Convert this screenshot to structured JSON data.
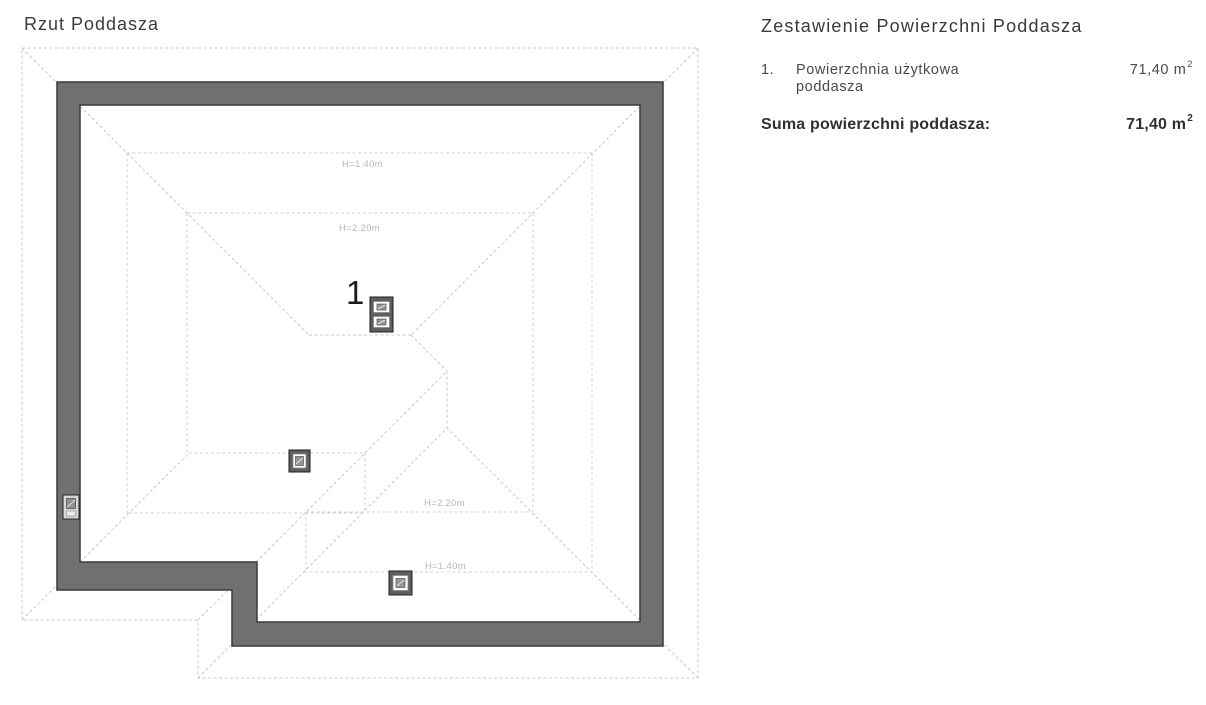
{
  "plan": {
    "title": "Rzut Poddasza",
    "room_number": "1",
    "labels": {
      "h140_top": "H=1.40m",
      "h220_top": "H=2.20m",
      "h220_bottom": "H=2.20m",
      "h140_bottom": "H=1.40m"
    },
    "colors": {
      "wall_fill": "#707070",
      "wall_outline": "#3a3a3a",
      "dashed_line": "#c9c9c9",
      "label_text": "#b6b6b6"
    }
  },
  "summary": {
    "title": "Zestawienie Powierzchni Poddasza",
    "rows": [
      {
        "index": "1.",
        "label_line1": "Powierzchnia użytkowa",
        "label_line2": "poddasza",
        "value": "71,40 m",
        "value_sup": "2"
      }
    ],
    "total": {
      "label": "Suma powierzchni poddasza:",
      "value": "71,40 m",
      "value_sup": "2"
    }
  }
}
